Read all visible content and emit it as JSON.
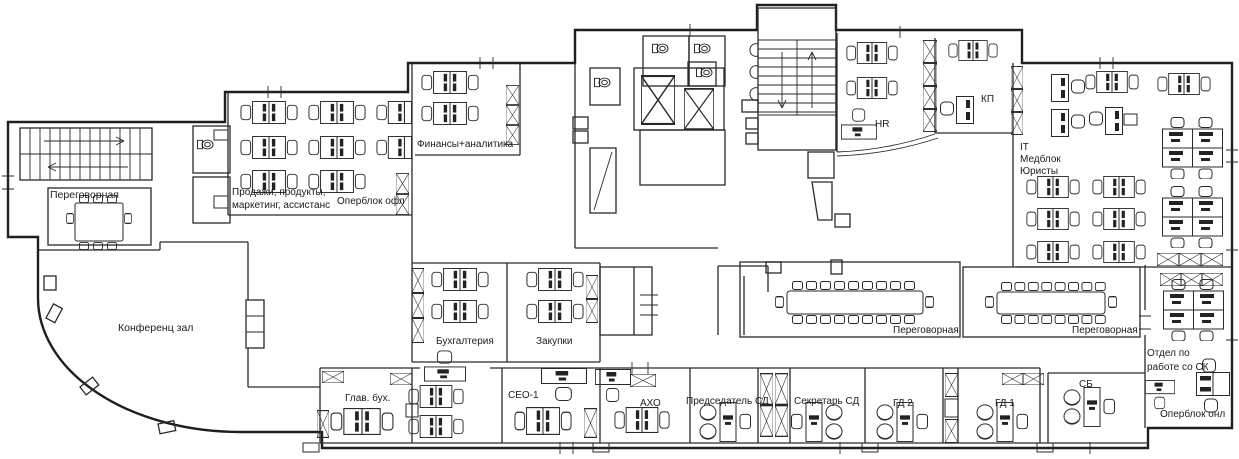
{
  "rooms": {
    "meeting_top_left": "Переговорная",
    "conference_hall": "Конференц зал",
    "sales_line1": "Продажи, продукты,",
    "sales_line2": "маркетинг, ассистанс",
    "operblock_offline": "Оперблок офл",
    "finance": "Финансы+аналитика",
    "hr": "HR",
    "kp": "КП",
    "it_line1": "IT",
    "it_line2": "Медблок",
    "it_line3": "Юристы",
    "accounting": "Бухгалтерия",
    "procurement": "Закупки",
    "meeting_center": "Переговорная",
    "meeting_right": "Переговорная",
    "sk_line1": "Отдел по",
    "sk_line2": "работе со СК",
    "chief_accountant": "Глав. бух.",
    "ceo": "СЕО-1",
    "aho": "АХО",
    "chairman": "Председатель СД",
    "secretary": "Секретарь СД",
    "gd2": "ГД 2",
    "gd1": "ГД 1",
    "sb": "СБ",
    "operblock_online": "Оперблок онл"
  },
  "colors": {
    "walls": "#2a2a2a",
    "background": "#ffffff",
    "furniture": "#222222"
  }
}
